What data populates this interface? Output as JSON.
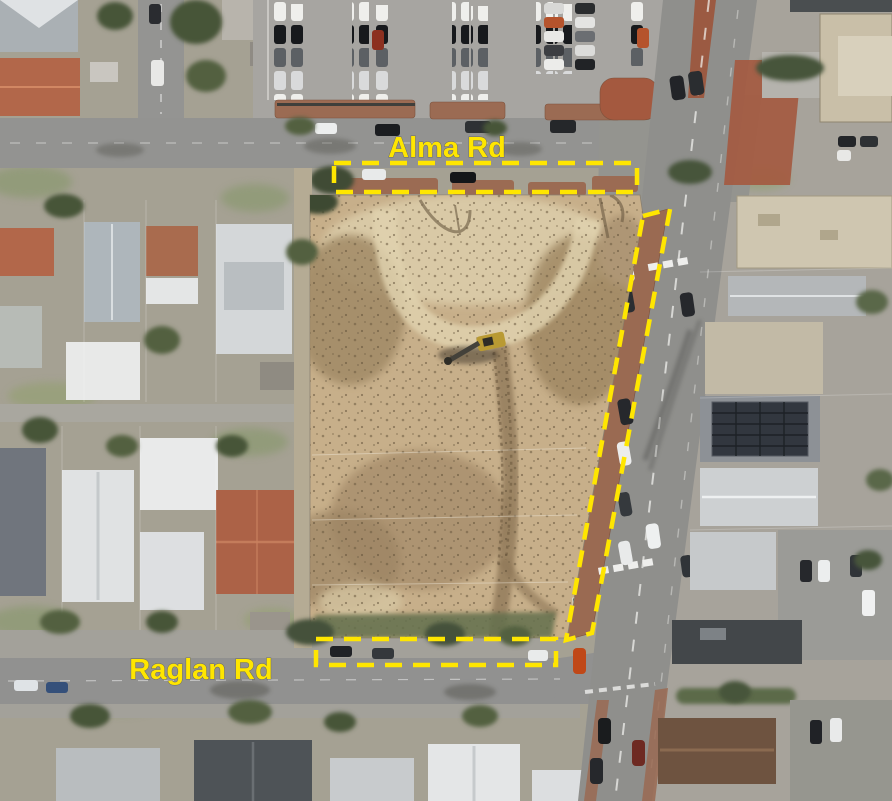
{
  "map": {
    "description": "Aerial photo of a cleared construction site bounded by Alma Rd to the north, Raglan Rd to the south and a main road to the east; yellow dashed boundaries mark the three road verges around the site.",
    "labels": [
      {
        "id": "alma-rd",
        "text": "Alma Rd"
      },
      {
        "id": "raglan-rd",
        "text": "Raglan Rd"
      }
    ],
    "annotation": {
      "color": "#FFE600",
      "line_style": "dashed"
    }
  }
}
